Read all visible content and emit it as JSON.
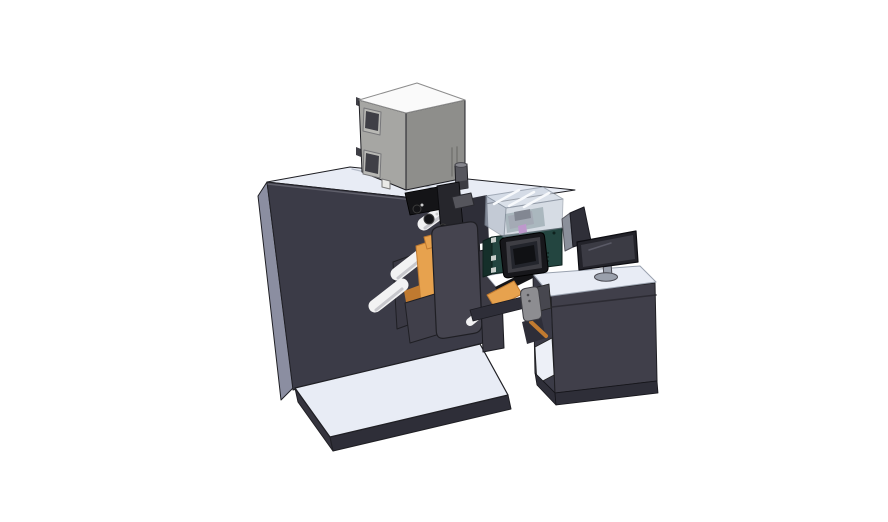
{
  "meta": {
    "title": "CAD render — label printing machine with operator desk",
    "subject": "Isometric 3D CAD rendering of a roll-fed label printing machine, electrical enclosure on top, inkjet printer unit with touchscreen under a transparent hood, and an operator desk with a desktop monitor"
  },
  "palette": {
    "bg": "#ffffff",
    "outline": "#1f1f24",
    "topLight": "#e8ecf5",
    "seam": "#b4bbc8",
    "edgeHi": "#5f5f6a",
    "sideGray": "#8b8ea1",
    "bodyDark": "#3b3b47",
    "bodyDark2": "#2e2e38",
    "plateDark": "#45444f",
    "baseSide": "#35343e",
    "grayBoxTop": "#fafafa",
    "grayBoxLeft": "#a6a6a3",
    "grayBoxFront": "#8e8e8b",
    "grayInset": "#3f3f46",
    "grayFrame": "#b9b9b5",
    "footLight": "#e9e9e7",
    "cylGray": "#57575e",
    "cylBand": "#3c3c43",
    "cylLight": "#85858c",
    "tealFront": "#234540",
    "tealSide": "#152f2a",
    "tealDark": "#0e211d",
    "padLight": "#c9cfcc",
    "frameBlack": "#17171b",
    "ringGray": "#3e3e44",
    "screenDark": "#23252c",
    "screenCore": "#101114",
    "hoodGlass": "#cdd5e1",
    "hoodGlassFront": "#bcc5d3",
    "hoodGlassSide": "#aab4c4",
    "hoodEdge": "#86909e",
    "strut": "#f7f9fc",
    "headGray": "#7e7e86",
    "headDark": "#2b2b31",
    "magenta": "#c356c3",
    "orange": "#e7a24e",
    "orangeDark": "#c07a30",
    "roller": "#f2f2f3",
    "rollerShade": "#c7c7cc",
    "mechBlack": "#141417",
    "mechDark": "#26262c",
    "mechGray": "#55555c",
    "speck": "#cccccc",
    "white": "#ffffff",
    "deskFront": "#403f4a",
    "deskSeam": "#2c2b33",
    "bayWhite": "#edf0f7",
    "monBezel": "#23232a",
    "monScreen": "#3b3b44",
    "monReflect": "#5a5a66",
    "standGray": "#9aa0ac",
    "standStroke": "#4a4a52",
    "pendantGray": "#8d8d91",
    "pendantDark": "#47474f",
    "armGray": "#3c3b45",
    "plate2": "#3a3944",
    "plate3": "#403f4a",
    "shieldDark": "#2f2f38",
    "shieldLight": "#8b909b",
    "dotLight": "#e2e6ee",
    "topStroke": "#9aa2af"
  },
  "components": {
    "main_cabinet": {
      "label": "Main cabinet"
    },
    "base_plate": {
      "label": "Base plate"
    },
    "electrical_box": {
      "label": "Electrical enclosure"
    },
    "canister": {
      "label": "Cylindrical canister"
    },
    "web_station": {
      "label": "Unwind roller station"
    },
    "print_mechanism": {
      "label": "Print mechanism"
    },
    "front_plate": {
      "label": "Front mounting plate"
    },
    "guide_rollers": {
      "label": "Guide rollers"
    },
    "printer_unit": {
      "label": "Printer unit with touchscreen"
    },
    "touchscreen": {
      "label": "Touchscreen"
    },
    "safety_hood": {
      "label": "Transparent safety hood"
    },
    "print_head": {
      "label": "Print head"
    },
    "operator_desk": {
      "label": "Operator desk"
    },
    "monitor": {
      "label": "Desktop monitor"
    },
    "side_shield": {
      "label": "Side shield panel"
    },
    "control_pendant": {
      "label": "Control pendant"
    }
  }
}
